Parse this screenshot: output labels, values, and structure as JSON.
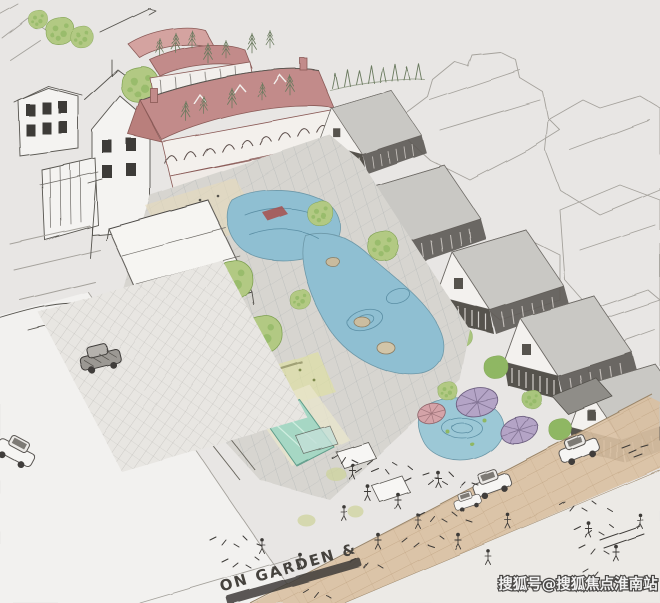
{
  "image": {
    "type": "hand-drawn architectural perspective sketch",
    "subject": "aerial sketch of a commercial street block with garden plaza, ponds, pool, umbrellas and parked cars",
    "street_label": "ON GARDEN &",
    "watermark": "搜狐号@搜狐焦点淮南站"
  },
  "palette": {
    "background": "#e8e6e4",
    "paper_white": "#f4f3f1",
    "sketch_line": "#57544f",
    "faint_line": "#a5a29c",
    "roof_pink": "#c28b8a",
    "roof_pink_light": "#d4a3a0",
    "roof_gray": "#c9c8c4",
    "wall_white": "#f3f0ec",
    "water_blue": "#8fbfd2",
    "water_stroke": "#51869c",
    "tree_green": "#b2c983",
    "tree_green_dark": "#8fb763",
    "pool_teal": "#a6d7c4",
    "road_tan": "#d9c0a2",
    "paving_gray": "#d7d5d0",
    "umbrella_purple": "#b4a4c6",
    "umbrella_pink": "#d4a3a8",
    "accent_red": "#a8504e",
    "step_dark": "#2f2d2a"
  }
}
